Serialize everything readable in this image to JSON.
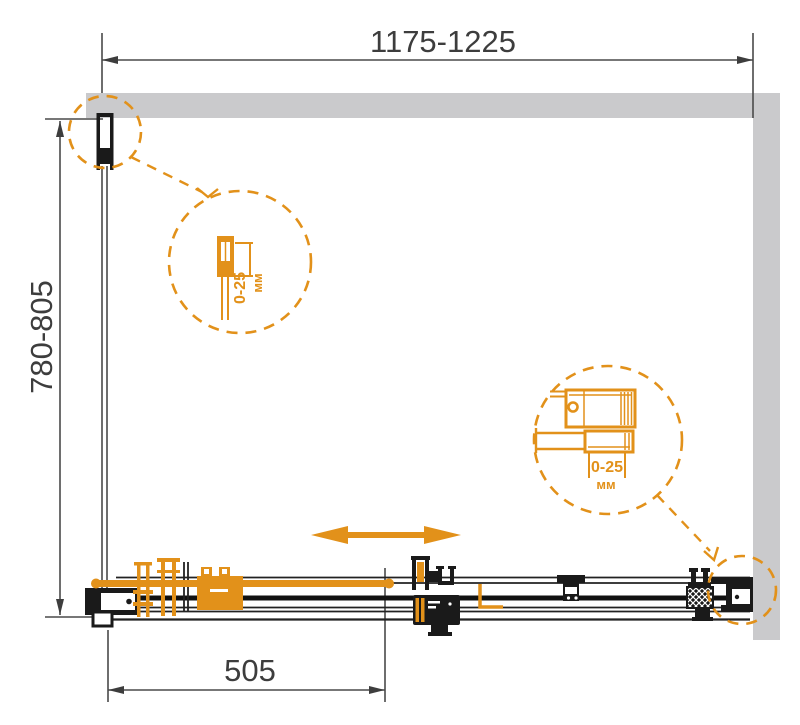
{
  "diagram": {
    "kind": "shower-enclosure-installation-drawing",
    "dimensions": {
      "width_range_mm": "1175-1225",
      "depth_range_mm": "780-805",
      "door_panel_mm": "505"
    },
    "callouts": {
      "top_left_profile": {
        "adjustment_range": "0-25",
        "unit": "мм"
      },
      "bottom_right_profile": {
        "adjustment_range": "0-25",
        "unit": "мм"
      }
    },
    "colors": {
      "accent_orange": "#E2911A",
      "wall_gray": "#CACACC",
      "line_dark": "#1A1A1A",
      "dim_gray": "#3D3D3D"
    }
  }
}
